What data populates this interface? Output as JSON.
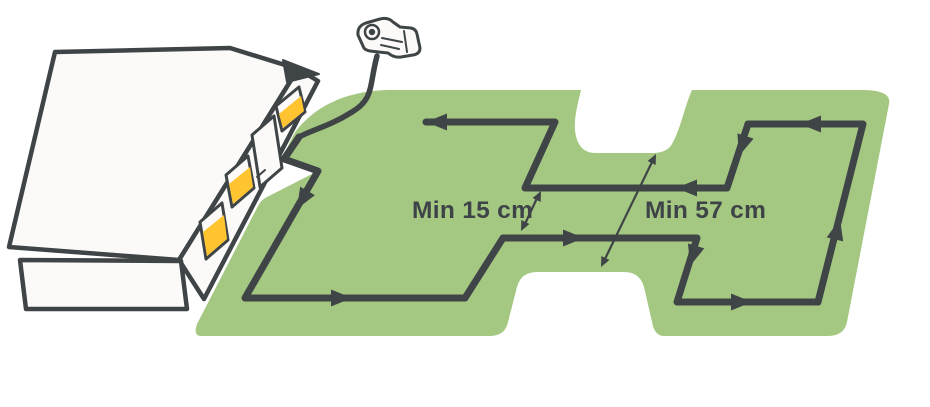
{
  "diagram": {
    "title": "Robotic mower boundary wire installation around a garden",
    "labels": {
      "min_wire_spacing": "Min 15 cm",
      "min_passage_width": "Min 57 cm"
    },
    "elements": {
      "house": {
        "windows": 3,
        "doors": 1
      },
      "power_plug": "power-plug",
      "boundary_wire_direction_arrows": 10,
      "dimension_arrows": 2,
      "lawn_notches": 2
    },
    "colors": {
      "background": "#ffffff",
      "lawn": "#a4c882",
      "wire": "#3f4447",
      "house-fill": "#fbfaf8",
      "house-stroke": "#3f4447",
      "window-yellow": "#ffc430",
      "text": "#3e4347"
    }
  }
}
